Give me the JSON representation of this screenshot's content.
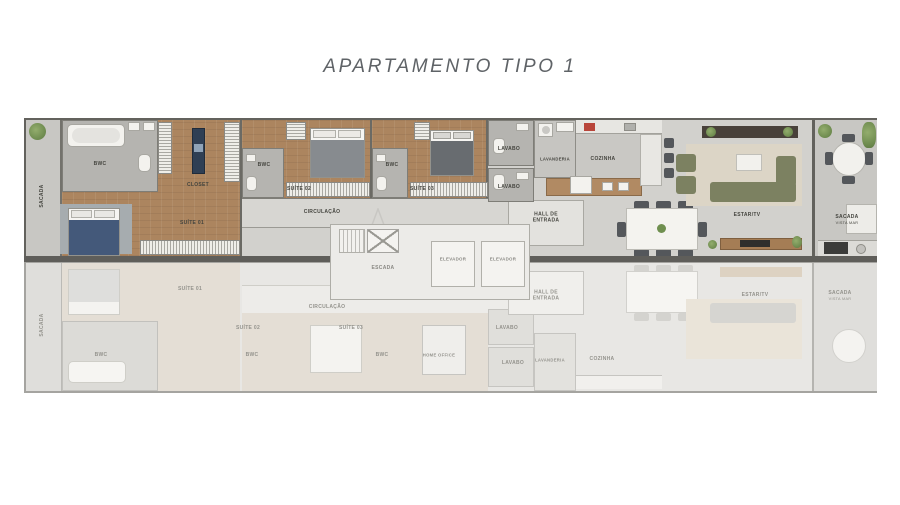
{
  "title": "APARTAMENTO TIPO 1",
  "palette": {
    "wood": "#ac855f",
    "tile": "#c8c7c3",
    "wall": "#63625d",
    "bed_navy": "#44597a",
    "sofa_olive": "#7c8161",
    "plant_green": "#6d8a4e"
  },
  "upper_unit": {
    "sacada_left": "SACADA",
    "bwc_suite1": "BWC",
    "closet": "CLOSET",
    "suite1": "SUÍTE 01",
    "suite2": "SUÍTE 02",
    "bwc_suite2": "BWC",
    "suite3": "SUÍTE 03",
    "bwc_suite3": "BWC",
    "circulacao": "CIRCULAÇÃO",
    "lavabo_1": "LAVABO",
    "lavabo_2": "LAVABO",
    "lavanderia": "LAVANDERIA",
    "cozinha": "COZINHA",
    "hall_entrada": "HALL DE ENTRADA",
    "estar_tv": "ESTAR/TV",
    "sacada_right": "SACADA",
    "sacada_right_sub": "VISTA MAR"
  },
  "core": {
    "escada": "ESCADA",
    "elevador_1": "ELEVADOR",
    "elevador_2": "ELEVADOR"
  },
  "lower_unit": {
    "sacada_left": "SACADA",
    "suite1": "SUÍTE 01",
    "suite2": "SUÍTE 02",
    "suite3": "SUÍTE 03",
    "bwc1": "BWC",
    "bwc2": "BWC",
    "bwc3": "BWC",
    "home_office": "HOME OFFICE",
    "circulacao": "CIRCULAÇÃO",
    "lavabo_1": "LAVABO",
    "lavabo_2": "LAVABO",
    "hall_entrada": "HALL DE ENTRADA",
    "lavanderia": "LAVANDERIA",
    "cozinha": "COZINHA",
    "estar_tv": "ESTAR/TV",
    "sacada_right": "SACADA",
    "sacada_right_sub": "VISTA MAR"
  }
}
